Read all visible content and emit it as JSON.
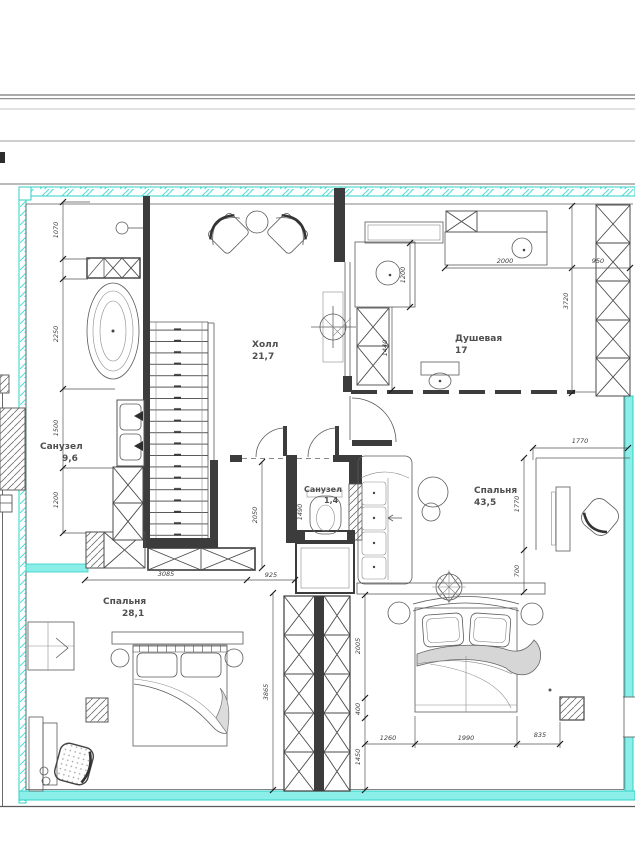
{
  "document": {
    "kind": "apartment floor plan drawing",
    "language": "ru"
  },
  "colors": {
    "exterior_wall_accent": "#7ceee7",
    "exterior_wall_edge": "#2fd0c6",
    "interior_wall": "#3c3c3c",
    "drawing_line": "#5a5a5a",
    "text": "#4f4f4f"
  },
  "rooms": {
    "hall": {
      "name": "Холл",
      "area": "21,7"
    },
    "shower": {
      "name": "Душевая",
      "area": "17"
    },
    "bathroom": {
      "name": "Санузел",
      "area": "9,6"
    },
    "wc": {
      "name": "Санузел",
      "area": "1,4"
    },
    "bedroom_right": {
      "name": "Спальня",
      "area": "43,5"
    },
    "bedroom_left": {
      "name": "Спальня",
      "area": "28,1"
    }
  },
  "dims": {
    "v1070": "1070",
    "v2250": "2250",
    "v1500": "1500",
    "v1200_left": "1200",
    "h3085": "3085",
    "h925": "925",
    "v2050": "2050",
    "v1490": "1490",
    "h2000": "2000",
    "h950": "950",
    "v1200_shower": "1200",
    "v1440": "1440",
    "v3720": "3720",
    "h1770": "1770",
    "v1770": "1770",
    "v700": "700",
    "v3865": "3865",
    "v2005": "2005",
    "v400": "400",
    "v1450": "1450",
    "h1260": "1260",
    "h1990": "1990",
    "h835": "835"
  }
}
